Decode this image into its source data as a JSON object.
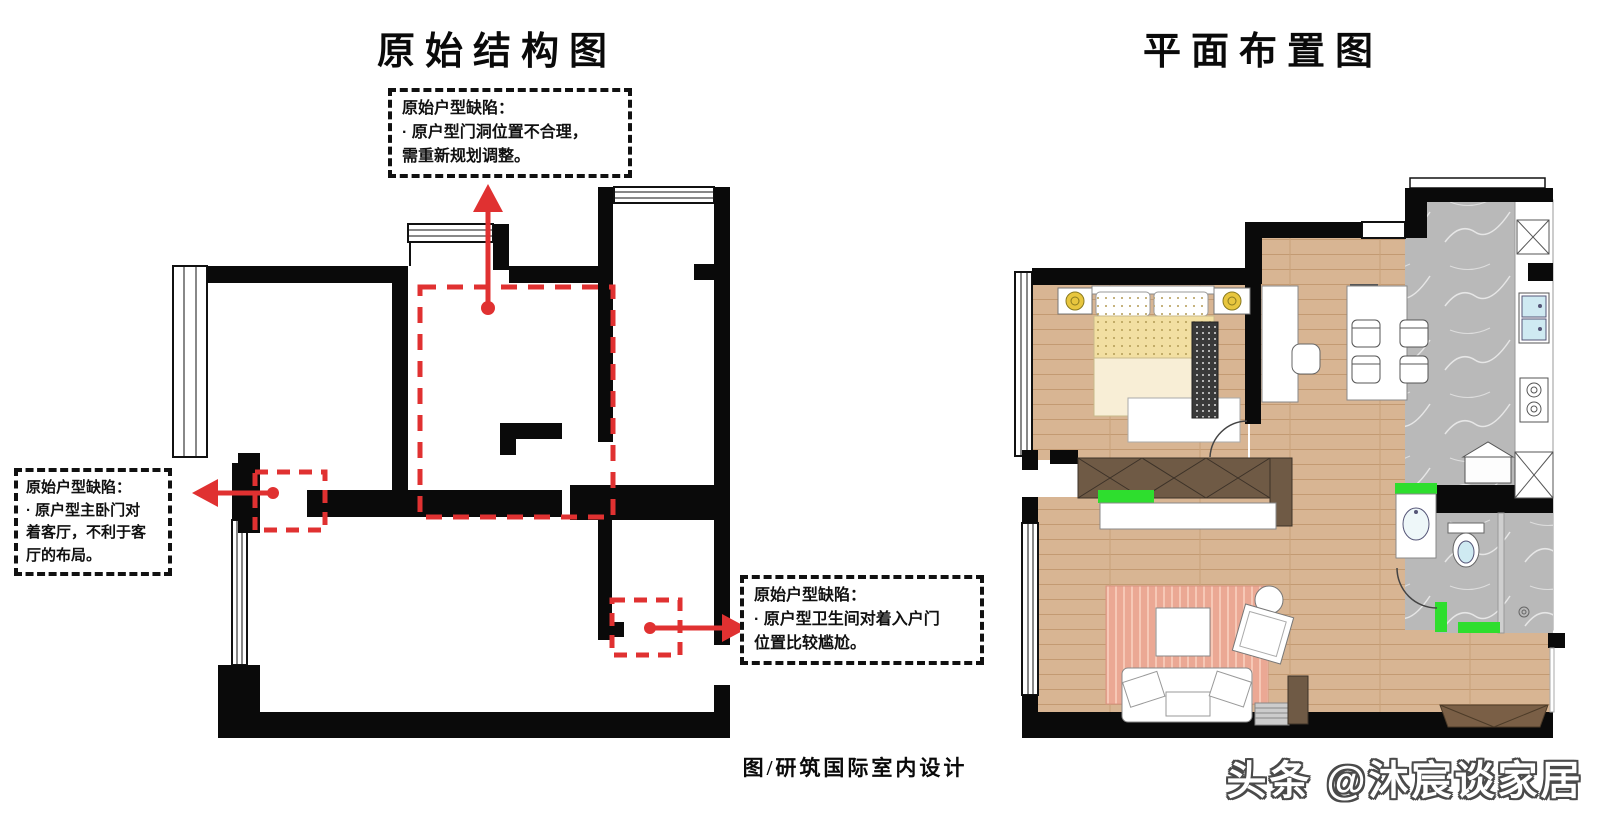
{
  "header": {
    "left_title": "原始结构图",
    "right_title": "平面布置图"
  },
  "annotations": {
    "door_defect": {
      "text": "原始户型缺陷：\n· 原户型门洞位置不合理，\n需重新规划调整。"
    },
    "bedroom_defect": {
      "text": "原始户型缺陷：\n· 原户型主卧门对\n着客厅，不利于客\n厅的布局。"
    },
    "bathroom_defect": {
      "text": "原始户型缺陷：\n· 原户型卫生间对着入户门\n位置比较尴尬。"
    }
  },
  "footer": {
    "caption": "图/研筑国际室内设计",
    "watermark": "头条 @沐宸谈家居"
  },
  "colors": {
    "annotation_red": "#e03131",
    "wall_black": "#0a0a0a",
    "wood_floor": "#d8b593",
    "marble_gray": "#b9b9b9",
    "accent_green": "#2ede2e",
    "cabinet_brown": "#6f5a45",
    "rug_pink": "#eba894",
    "lamp_yellow": "#e8c63e"
  }
}
